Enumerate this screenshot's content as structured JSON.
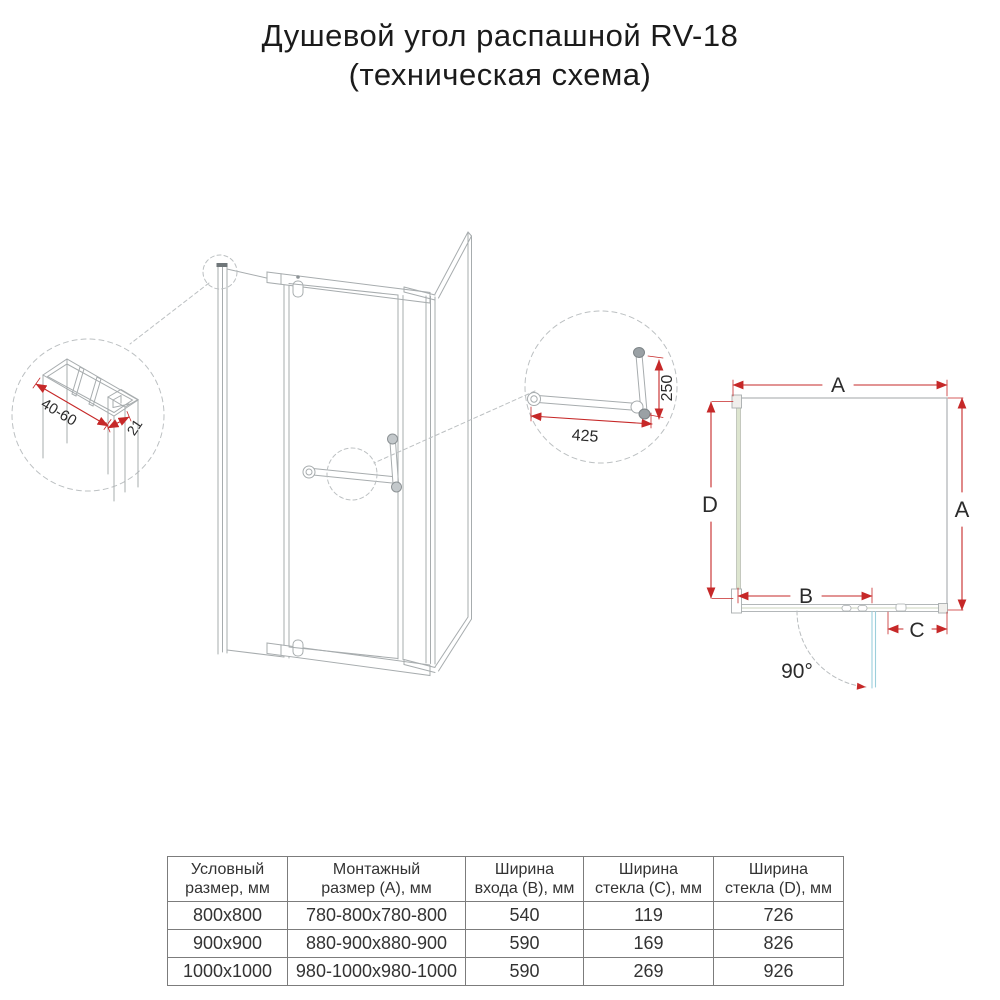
{
  "title": {
    "line1": "Душевой угол распашной RV-18",
    "line2": "(техническая схема)"
  },
  "detail_profile": {
    "dim_wall_range": "40-60",
    "dim_profile_depth": "21"
  },
  "detail_handle": {
    "dim_towel_bar_length": "425",
    "dim_handle_height": "250"
  },
  "plan_view": {
    "dim_top": "A",
    "dim_left": "D",
    "dim_right": "A",
    "dim_entry": "B",
    "dim_fixed_glass": "C",
    "door_open_angle": "90°"
  },
  "colors": {
    "dimension_red": "#c62828",
    "drawing_gray": "#a7acae",
    "door_teal": "#9ccfdb",
    "glass_green": "#dde5cf",
    "text_dark": "#2b2b2b"
  },
  "table": {
    "headers": [
      {
        "line1": "Условный",
        "line2": "размер, мм"
      },
      {
        "line1": "Монтажный",
        "line2": "размер (A), мм"
      },
      {
        "line1": "Ширина",
        "line2": "входа (B), мм"
      },
      {
        "line1": "Ширина",
        "line2": "стекла (C), мм"
      },
      {
        "line1": "Ширина",
        "line2": "стекла (D), мм"
      }
    ],
    "rows": [
      [
        "800x800",
        "780-800x780-800",
        "540",
        "119",
        "726"
      ],
      [
        "900x900",
        "880-900x880-900",
        "590",
        "169",
        "826"
      ],
      [
        "1000x1000",
        "980-1000x980-1000",
        "590",
        "269",
        "926"
      ]
    ]
  }
}
